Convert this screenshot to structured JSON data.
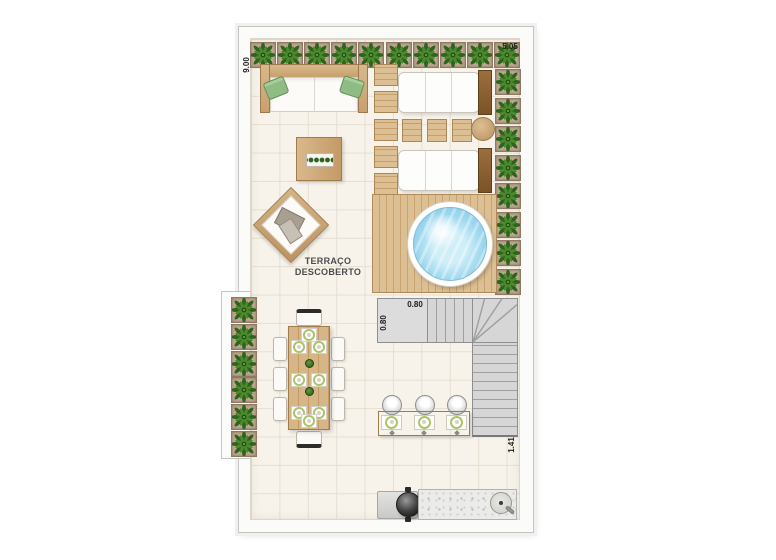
{
  "room": {
    "label": [
      "TERRAÇO",
      "DESCOBERTO"
    ]
  },
  "dimensions": {
    "left_height": "9.00",
    "top_width": "5.05",
    "stair_width": "0.80",
    "stair_depth": "0.80",
    "stair_clearance": "1.41"
  },
  "counts": {
    "planters_top": 10,
    "planters_right": 8,
    "planters_left": 6,
    "deck_squares": 5,
    "lounger_side_tables": 3,
    "loungers": 2,
    "bar_stools": 3,
    "bar_place_settings": 3,
    "dining_side_chairs": 3,
    "dining_side_plates": 3,
    "dining_seats": 8
  },
  "colors": {
    "floor": "#f7f3ea",
    "floor_grid": "#e6dfd1",
    "wall": "#fbfbfa",
    "wood_light": "#d8b98c",
    "wood_dark": "#8a6138",
    "plant_green": "#2f6320",
    "pool_water": "#8ccdea",
    "stair_gray": "#d6d6d6",
    "cushion_white": "#fdfdfb",
    "plate_rim_green": "#a9c46a",
    "granite": "#ebebe9"
  }
}
